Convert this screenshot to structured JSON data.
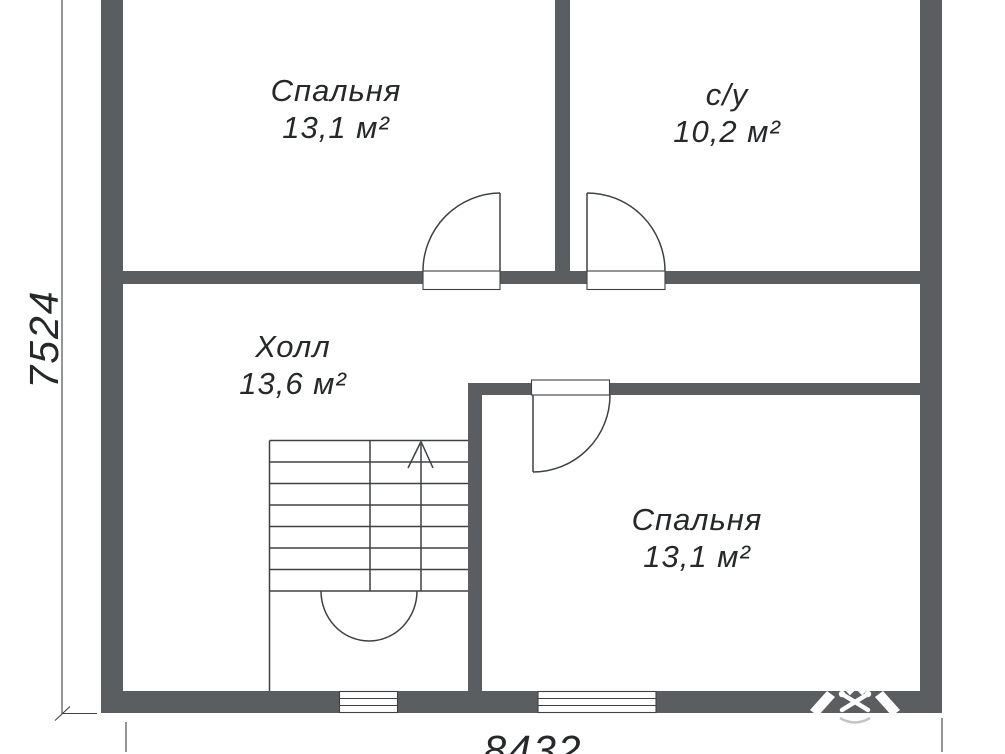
{
  "colors": {
    "wall": "#5a5e61",
    "line": "#3e4144",
    "text": "#26282a",
    "watermark": "#c2c5c7"
  },
  "rooms": [
    {
      "id": "bedroom-top",
      "name": "Спальня",
      "area": "13,1 м²"
    },
    {
      "id": "bathroom",
      "name": "с/у",
      "area": "10,2 м²"
    },
    {
      "id": "hall",
      "name": "Холл",
      "area": "13,6 м²"
    },
    {
      "id": "bedroom-bottom",
      "name": "Спальня",
      "area": "13,1 м²"
    }
  ],
  "dimensions": {
    "left": "7524",
    "bottom": "8432"
  },
  "icons": {
    "stairs_direction": "up-arrow",
    "watermark": "builder-emblem-watermark"
  }
}
